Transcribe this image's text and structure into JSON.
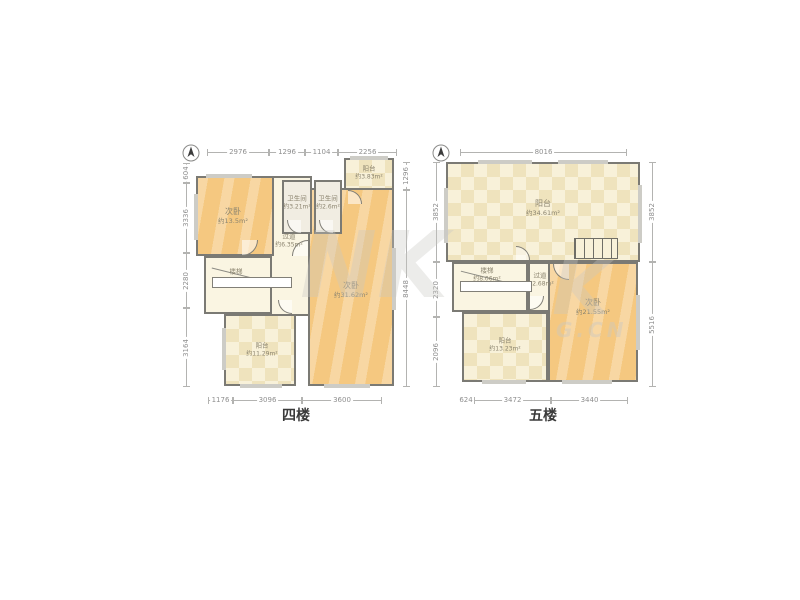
{
  "meta": {
    "canvas_bg": "#ffffff"
  },
  "colors": {
    "wood_room": "#f5c880",
    "checker_room": "#f8f1d9",
    "checker_tile": "#efe3bd",
    "corridor": "#faf5e2",
    "bathroom": "#f1ede2",
    "wall": "#7b7a74",
    "dimension_text": "#8f8f8f",
    "room_label_text": "#8b846f",
    "floor_title_text": "#3a3a3a"
  },
  "floor4": {
    "title": "四楼",
    "compass": "north-arrow",
    "dims_top": [
      "2976",
      "1296",
      "1104",
      "2256"
    ],
    "dims_left": [
      "604",
      "3336",
      "2280",
      "3164"
    ],
    "dims_right": [
      "1296",
      "8448"
    ],
    "dims_bottom": [
      "1176",
      "3096",
      "3600"
    ],
    "rooms": {
      "bedroom_small": {
        "name": "次卧",
        "area": "约13.5m²"
      },
      "bathroom_1": {
        "name": "卫生间",
        "area": "约3.21m²"
      },
      "bathroom_2": {
        "name": "卫生间",
        "area": "约2.6m²"
      },
      "balcony_top": {
        "name": "阳台",
        "area": "约3.83m²"
      },
      "hallway": {
        "name": "过道",
        "area": "约6.35m²"
      },
      "stairs": {
        "name": "楼梯",
        "area": ""
      },
      "bedroom_large": {
        "name": "次卧",
        "area": "约31.62m²"
      },
      "balcony_bottom": {
        "name": "阳台",
        "area": "约11.29m²"
      }
    }
  },
  "floor5": {
    "title": "五楼",
    "compass": "north-arrow",
    "dims_top": [
      "8016"
    ],
    "dims_left": [
      "3852",
      "2320",
      "2096"
    ],
    "dims_right": [
      "3852",
      "5516"
    ],
    "dims_bottom": [
      "624",
      "3472",
      "3440"
    ],
    "rooms": {
      "terrace": {
        "name": "阳台",
        "area": "约34.61m²"
      },
      "stairs": {
        "name": "楼梯",
        "area": "约8.06m²"
      },
      "hallway": {
        "name": "过道",
        "area": "约2.68m²"
      },
      "bedroom": {
        "name": "次卧",
        "area": "约21.55m²"
      },
      "balcony": {
        "name": "阳台",
        "area": "约13.23m²"
      }
    }
  },
  "watermark": {
    "left_fragment": "NK",
    "right_fragment": "K",
    "right_domain": "G.CN"
  }
}
